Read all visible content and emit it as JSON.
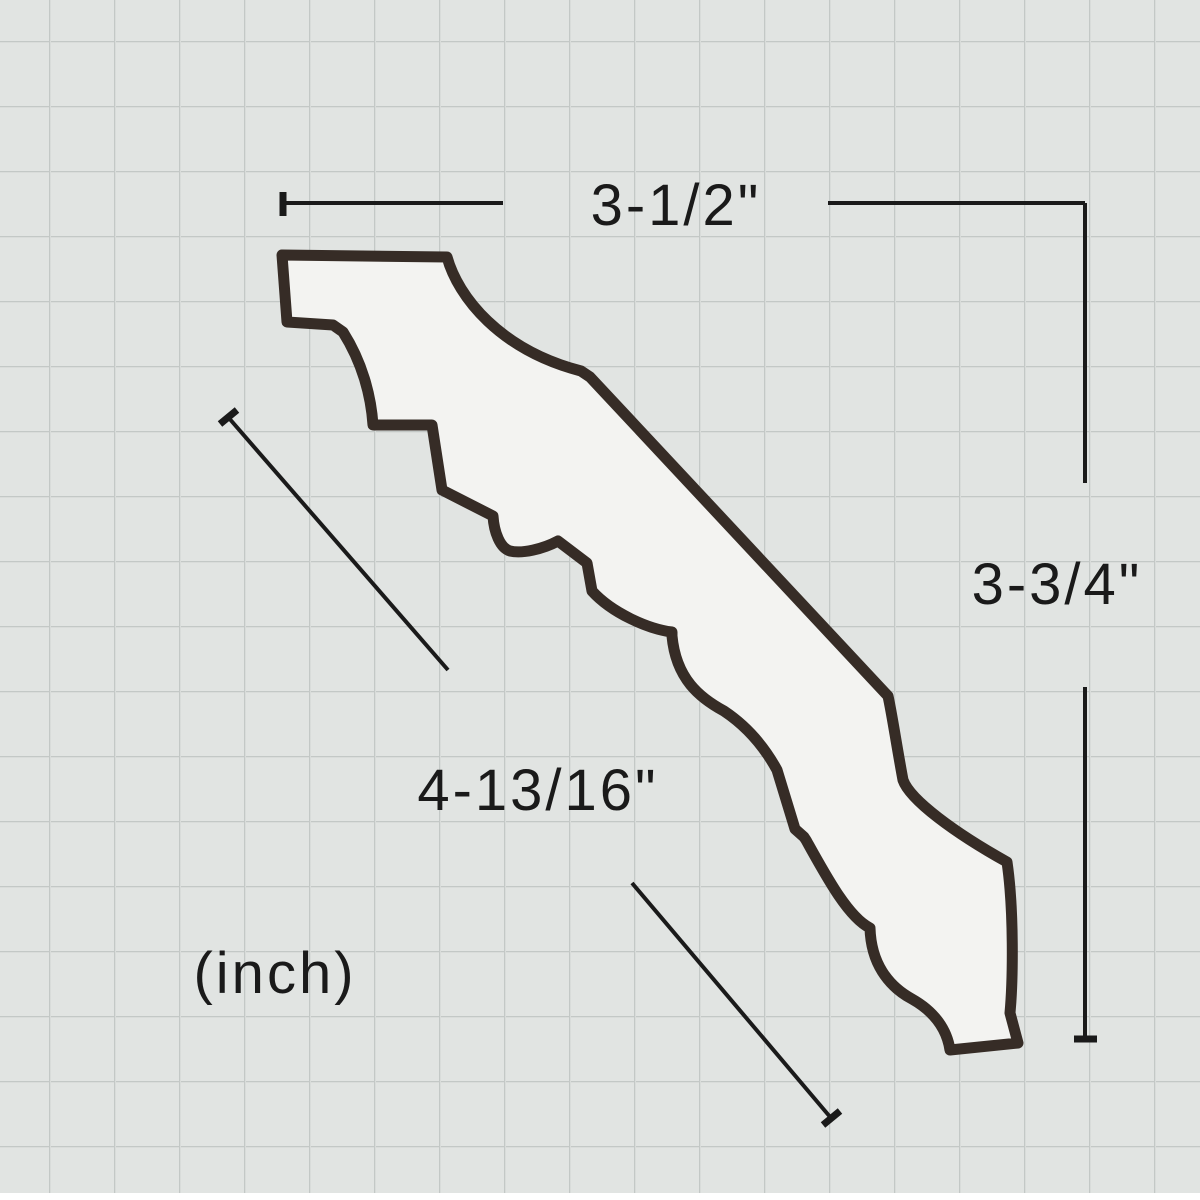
{
  "page": {
    "background_color": "#e1e4e2",
    "grid_line_color": "#c3c8c6",
    "grid_cell_px": 65
  },
  "diagram": {
    "subject": "crown-molding-profile-cross-section",
    "shape": {
      "fill_color": "#f3f3f1",
      "outline_color": "#362c26",
      "outline_width_px": 11
    },
    "dimension_style": {
      "line_color": "#1a1a1a",
      "line_width_px": 4
    },
    "dimensions": {
      "top_width": "3-1/2\"",
      "right_height": "3-3/4\"",
      "diagonal_face": "4-13/16\"",
      "unit_note": "(inch)"
    }
  }
}
